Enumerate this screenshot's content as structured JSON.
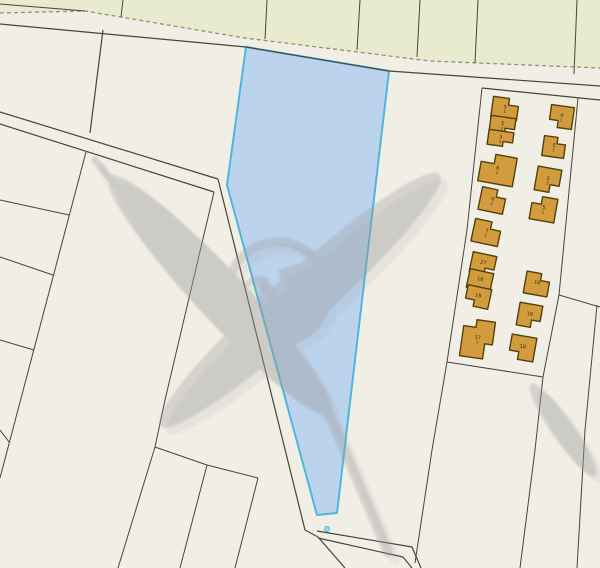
{
  "map": {
    "width": 600,
    "height": 568,
    "background_color": "#f1eee6",
    "line_color": "#45453c",
    "dash_color": "#90907c",
    "green_zone": {
      "fill": "#e9ebce",
      "outline_points": "0,0 600,0 600,68 430,61 245,38 85,11 0,13",
      "dashed_boundary_points": "0,13 85,11 245,38 430,61 600,68",
      "left_inner_line": "0,4 85,11",
      "dividers": [
        "123,0 121,17",
        "267,0 265,39",
        "360,0 357,50",
        "420,0 417,57",
        "478,0 475,63",
        "577,0 574,74"
      ]
    },
    "road_lines": [
      "0,24 246,47 389,71 600,86",
      "482,88 600,100",
      "0,112 218,179",
      "0,124 214,192",
      "218,179 305,530 318,537",
      "318,537 345,568",
      "317,531 412,547 421,568",
      "318,538 403,557 412,568",
      "103,30 90,133"
    ],
    "parcel_lines": [
      "86,152 0,478",
      "0,200 69,215",
      "0,257 53,275",
      "0,340 34,350",
      "0,430 9,442",
      "214,192 165,400 155,447 118,568",
      "155,447 207,465 258,478",
      "207,465 180,568",
      "258,478 235,568",
      "482,88 467,230 447,362",
      "447,362 543,377",
      "578,98 559,295 543,377",
      "559,295 600,307",
      "597,305 585,430 577,568",
      "447,362 432,450 415,563",
      "543,377 535,450 520,568"
    ],
    "selected_parcel": {
      "fill": "#bcd3ee",
      "stroke": "#4fb6da",
      "stroke_width": 2,
      "points": "246,47 389,71 337,513 317,515 227,185",
      "marker_dot": {
        "cx": 327,
        "cy": 529,
        "r": 2.5,
        "fill": "#9edbe9",
        "stroke": "#4fb6da"
      }
    },
    "buildings": {
      "fill": "#d29c3e",
      "stroke": "#53400a",
      "label_color": "#3a2b05",
      "items": [
        {
          "x": 492,
          "y": 98,
          "w": 26,
          "h": 21,
          "rot": 8,
          "notch": "tr",
          "label": "5",
          "sub": "1"
        },
        {
          "x": 490,
          "y": 117,
          "w": 25,
          "h": 16,
          "rot": 8,
          "notch": "br",
          "label": "5",
          "sub": "2"
        },
        {
          "x": 488,
          "y": 131,
          "w": 25,
          "h": 15,
          "rot": 8,
          "notch": "br",
          "label": "3",
          "sub": "1"
        },
        {
          "x": 480,
          "y": 155,
          "w": 35,
          "h": 29,
          "rot": 10,
          "notch": "tl",
          "label": "6",
          "sub": "1"
        },
        {
          "x": 480,
          "y": 189,
          "w": 25,
          "h": 23,
          "rot": 12,
          "notch": "tr",
          "label": "6",
          "sub": "2"
        },
        {
          "x": 473,
          "y": 221,
          "w": 27,
          "h": 23,
          "rot": 12,
          "notch": "tr",
          "label": "7",
          "sub": "1"
        },
        {
          "x": 471,
          "y": 254,
          "w": 24,
          "h": 20,
          "rot": 12,
          "notch": "br",
          "label": "27",
          "sub": ""
        },
        {
          "x": 468,
          "y": 271,
          "w": 24,
          "h": 19,
          "rot": 12,
          "notch": "none",
          "label": "18",
          "sub": ""
        },
        {
          "x": 466,
          "y": 287,
          "w": 24,
          "h": 20,
          "rot": 12,
          "notch": "bl",
          "label": "19",
          "sub": ""
        },
        {
          "x": 462,
          "y": 320,
          "w": 31,
          "h": 38,
          "rot": 8,
          "notch": "cross",
          "label": "17",
          "sub": "1"
        },
        {
          "x": 550,
          "y": 106,
          "w": 23,
          "h": 22,
          "rot": 8,
          "notch": "bl",
          "label": "4",
          "sub": "1"
        },
        {
          "x": 543,
          "y": 137,
          "w": 22,
          "h": 20,
          "rot": 8,
          "notch": "tr",
          "label": "5",
          "sub": "1"
        },
        {
          "x": 536,
          "y": 168,
          "w": 24,
          "h": 24,
          "rot": 10,
          "notch": "br",
          "label": "5",
          "sub": "2"
        },
        {
          "x": 531,
          "y": 197,
          "w": 25,
          "h": 24,
          "rot": 10,
          "notch": "tl",
          "label": "5",
          "sub": "1"
        },
        {
          "x": 525,
          "y": 273,
          "w": 24,
          "h": 22,
          "rot": 10,
          "notch": "tr",
          "label": "16",
          "sub": ""
        },
        {
          "x": 518,
          "y": 304,
          "w": 23,
          "h": 23,
          "rot": 10,
          "notch": "br",
          "label": "16",
          "sub": ""
        },
        {
          "x": 510,
          "y": 336,
          "w": 25,
          "h": 24,
          "rot": 10,
          "notch": "bl",
          "label": "18",
          "sub": ""
        }
      ]
    },
    "watermark": {
      "text": "2B",
      "color": "#9d9d9b",
      "opacity": 0.34
    }
  }
}
